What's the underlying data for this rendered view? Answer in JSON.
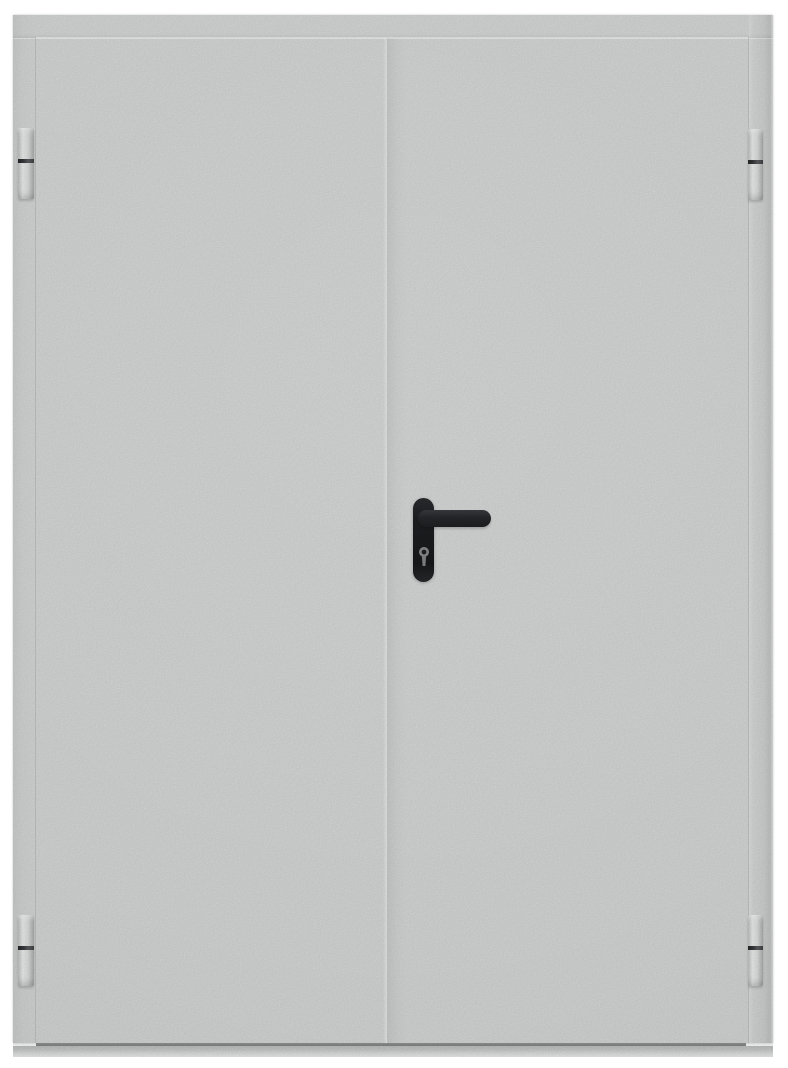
{
  "scene": {
    "type": "product-photo",
    "description": "Closed double-leaf gray metal technical door with four barrel hinges, a black lever handle and a euro-profile keyhole escutcheon on the right leaf, on a white background",
    "background_color": "#ffffff"
  },
  "colors": {
    "background": "#ffffff",
    "door_base": "#d8dad9",
    "edge_line": "#b9bbba",
    "seam_line": "#e9eae9",
    "gap_dark": "#838586",
    "threshold_gray": "#c7c9c8",
    "hinge_light": "#eef0ef",
    "hinge_dark": "#aeb0af",
    "hinge_joint": "#333538",
    "handle_black": "#1e2023",
    "handle_sheen": "#3a3c40",
    "keyhole_metal": "#8b8d8f"
  },
  "door": {
    "leaf_count": 2,
    "leaves": [
      {
        "id": "left-leaf",
        "hardware": "none"
      },
      {
        "id": "right-leaf",
        "hardware": "lever handle with keyhole escutcheon"
      }
    ],
    "hinges": [
      {
        "id": "hinge-top-left",
        "side": "left",
        "position": "top"
      },
      {
        "id": "hinge-bottom-left",
        "side": "left",
        "position": "bottom"
      },
      {
        "id": "hinge-top-right",
        "side": "right",
        "position": "top"
      },
      {
        "id": "hinge-bottom-right",
        "side": "right",
        "position": "bottom"
      }
    ],
    "hardware": {
      "lever_handle": {
        "color": "#1e2023",
        "direction": "pointing-right"
      },
      "escutcheon": {
        "type": "euro-profile-keyhole",
        "color": "#1e2023"
      }
    }
  }
}
